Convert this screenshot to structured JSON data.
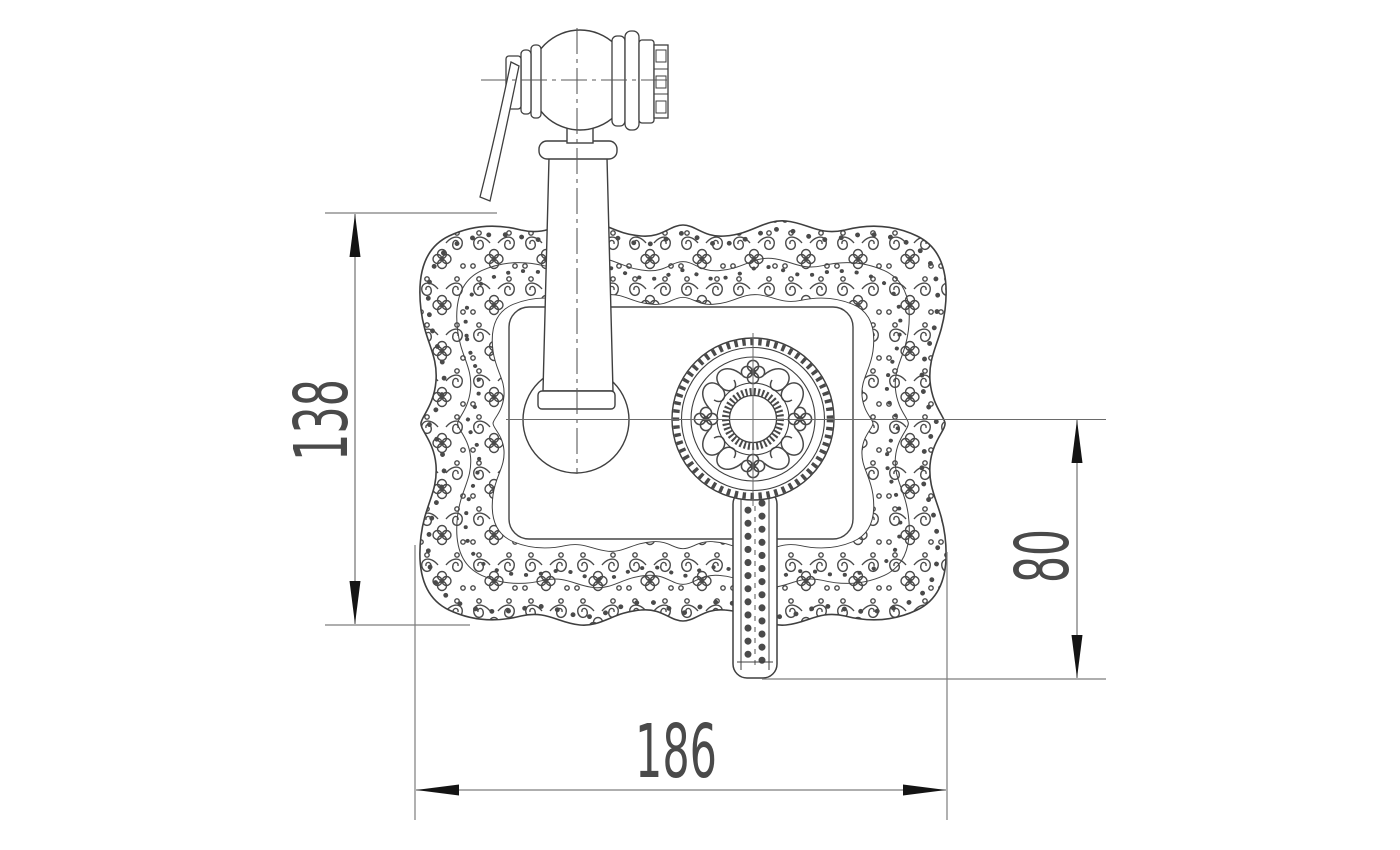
{
  "drawing": {
    "type": "technical-dimension-drawing",
    "subject": "wall-mounted hygienic hand shower with ornate escutcheon plate, control knob and hose stub",
    "dimension_labels": {
      "left_vertical": "138",
      "right_vertical": "80",
      "bottom_horizontal": "186"
    },
    "colors": {
      "background": "#ffffff",
      "outline": "#3f3f3f",
      "ornament": "#4a4a4a",
      "centerline": "#5a5a5a",
      "dimension_line": "#7d7d7d",
      "arrow": "#141414",
      "label_text": "#4a4a4a"
    }
  }
}
